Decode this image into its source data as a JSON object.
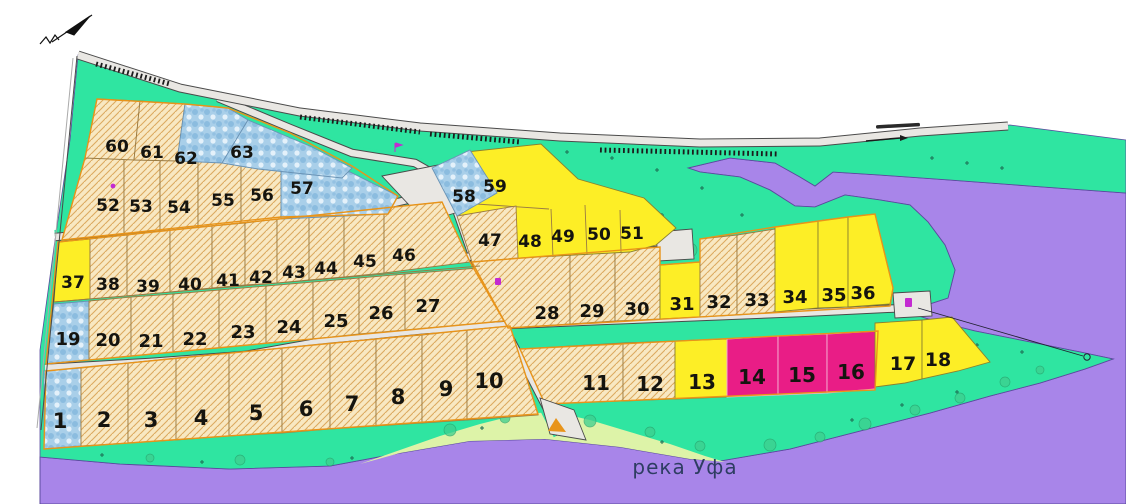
{
  "map": {
    "river_label": "река Уфа",
    "north_arrow_icon": "north-arrow-icon",
    "road_direction_icon": "direction-arrow-icon"
  },
  "palette": {
    "water_purple": "#a885e9",
    "water_outline": "#5b4a9e",
    "green_verge": "#2fe5a1",
    "light_shore": "#ddf3a8",
    "beige": "#f8e8c2",
    "beige_hatch": "#dcaa60",
    "plot_border_brown": "#9a7b43",
    "block_outline_orange": "#e8941a",
    "yellow": "#fdee26",
    "pink": "#e91d86",
    "pink_border": "#f6b9d5",
    "blue_base": "#a9cfe9",
    "blue_marble_dark": "#7fb4dc",
    "blue_marble_light": "#eaf5fc",
    "road_fill": "#e9e7e3",
    "road_casing": "#4a4a4a",
    "rail_dark": "#1c1c1c",
    "river_text": "#2e3d62",
    "tree_fill": "#3ecf8f",
    "tree_stroke": "#27a06b",
    "cross_mark": "#1c6e54",
    "marker_magenta": "#c32ad1",
    "ramp_orange": "#e8941a"
  },
  "plots": [
    {
      "n": "1",
      "zone": "blue"
    },
    {
      "n": "2",
      "zone": "beige"
    },
    {
      "n": "3",
      "zone": "beige"
    },
    {
      "n": "4",
      "zone": "beige"
    },
    {
      "n": "5",
      "zone": "beige"
    },
    {
      "n": "6",
      "zone": "beige"
    },
    {
      "n": "7",
      "zone": "beige"
    },
    {
      "n": "8",
      "zone": "beige"
    },
    {
      "n": "9",
      "zone": "beige"
    },
    {
      "n": "10",
      "zone": "beige"
    },
    {
      "n": "11",
      "zone": "beige"
    },
    {
      "n": "12",
      "zone": "beige"
    },
    {
      "n": "13",
      "zone": "yellow"
    },
    {
      "n": "14",
      "zone": "pink"
    },
    {
      "n": "15",
      "zone": "pink"
    },
    {
      "n": "16",
      "zone": "pink"
    },
    {
      "n": "17",
      "zone": "yellow"
    },
    {
      "n": "18",
      "zone": "yellow"
    },
    {
      "n": "19",
      "zone": "blue"
    },
    {
      "n": "20",
      "zone": "beige"
    },
    {
      "n": "21",
      "zone": "beige"
    },
    {
      "n": "22",
      "zone": "beige"
    },
    {
      "n": "23",
      "zone": "beige"
    },
    {
      "n": "24",
      "zone": "beige"
    },
    {
      "n": "25",
      "zone": "beige"
    },
    {
      "n": "26",
      "zone": "beige"
    },
    {
      "n": "27",
      "zone": "beige"
    },
    {
      "n": "28",
      "zone": "beige"
    },
    {
      "n": "29",
      "zone": "beige"
    },
    {
      "n": "30",
      "zone": "beige"
    },
    {
      "n": "31",
      "zone": "yellow"
    },
    {
      "n": "32",
      "zone": "beige"
    },
    {
      "n": "33",
      "zone": "beige"
    },
    {
      "n": "34",
      "zone": "yellow"
    },
    {
      "n": "35",
      "zone": "yellow"
    },
    {
      "n": "36",
      "zone": "yellow"
    },
    {
      "n": "37",
      "zone": "yellow"
    },
    {
      "n": "38",
      "zone": "beige"
    },
    {
      "n": "39",
      "zone": "beige"
    },
    {
      "n": "40",
      "zone": "beige"
    },
    {
      "n": "41",
      "zone": "beige"
    },
    {
      "n": "42",
      "zone": "beige"
    },
    {
      "n": "43",
      "zone": "beige"
    },
    {
      "n": "44",
      "zone": "beige"
    },
    {
      "n": "45",
      "zone": "beige"
    },
    {
      "n": "46",
      "zone": "beige"
    },
    {
      "n": "47",
      "zone": "beige"
    },
    {
      "n": "48",
      "zone": "yellow"
    },
    {
      "n": "49",
      "zone": "yellow"
    },
    {
      "n": "50",
      "zone": "yellow"
    },
    {
      "n": "51",
      "zone": "yellow"
    },
    {
      "n": "52",
      "zone": "beige"
    },
    {
      "n": "53",
      "zone": "beige"
    },
    {
      "n": "54",
      "zone": "beige"
    },
    {
      "n": "55",
      "zone": "beige"
    },
    {
      "n": "56",
      "zone": "beige"
    },
    {
      "n": "57",
      "zone": "blue"
    },
    {
      "n": "58",
      "zone": "blue"
    },
    {
      "n": "59",
      "zone": "yellow"
    },
    {
      "n": "60",
      "zone": "beige"
    },
    {
      "n": "61",
      "zone": "beige"
    },
    {
      "n": "62",
      "zone": "blue"
    },
    {
      "n": "63",
      "zone": "blue"
    }
  ]
}
